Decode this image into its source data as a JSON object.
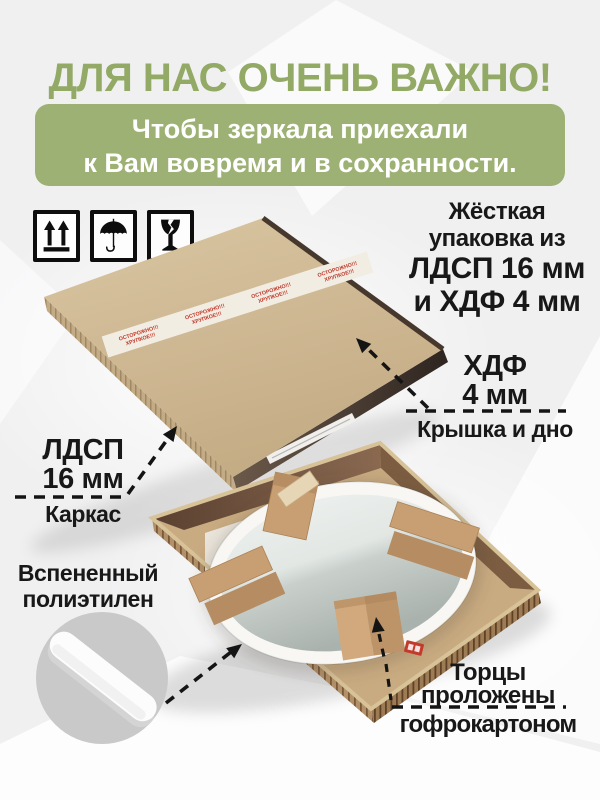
{
  "title": "ДЛЯ НАС ОЧЕНЬ ВАЖНО!",
  "banner": {
    "line1": "Чтобы зеркала приехали",
    "line2": "к Вам вовремя и в сохранности."
  },
  "handling_icons": [
    {
      "name": "this-way-up-icon"
    },
    {
      "name": "keep-dry-icon"
    },
    {
      "name": "fragile-icon"
    }
  ],
  "tape": {
    "line1": "ОСТОРОЖНО!!!",
    "line2": "ХРУПКОЕ!!!"
  },
  "callouts": {
    "packaging": {
      "line1": "Жёсткая",
      "line2": "упаковка из",
      "line3": "ЛДСП 16 мм",
      "line4": "и ХДФ 4 мм"
    },
    "hdf": {
      "line1": "ХДФ",
      "line2": "4 мм",
      "sub": "Крышка и дно"
    },
    "ldsp": {
      "line1": "ЛДСП",
      "line2": "16 мм",
      "sub": "Каркас"
    },
    "foam": {
      "line1": "Вспененный",
      "line2": "полиэтилен"
    },
    "edges": {
      "line1": "Торцы",
      "line2": "проложены",
      "line3": "гофрокартоном"
    }
  },
  "colors": {
    "title_green": "#92aa65",
    "banner_green": "#9cb173",
    "text_black": "#181818",
    "kraft": "#cfba96",
    "walnut": "#5a4030",
    "tape_red": "#c0392b",
    "foam_circle_gray": "#c9c9c9"
  }
}
